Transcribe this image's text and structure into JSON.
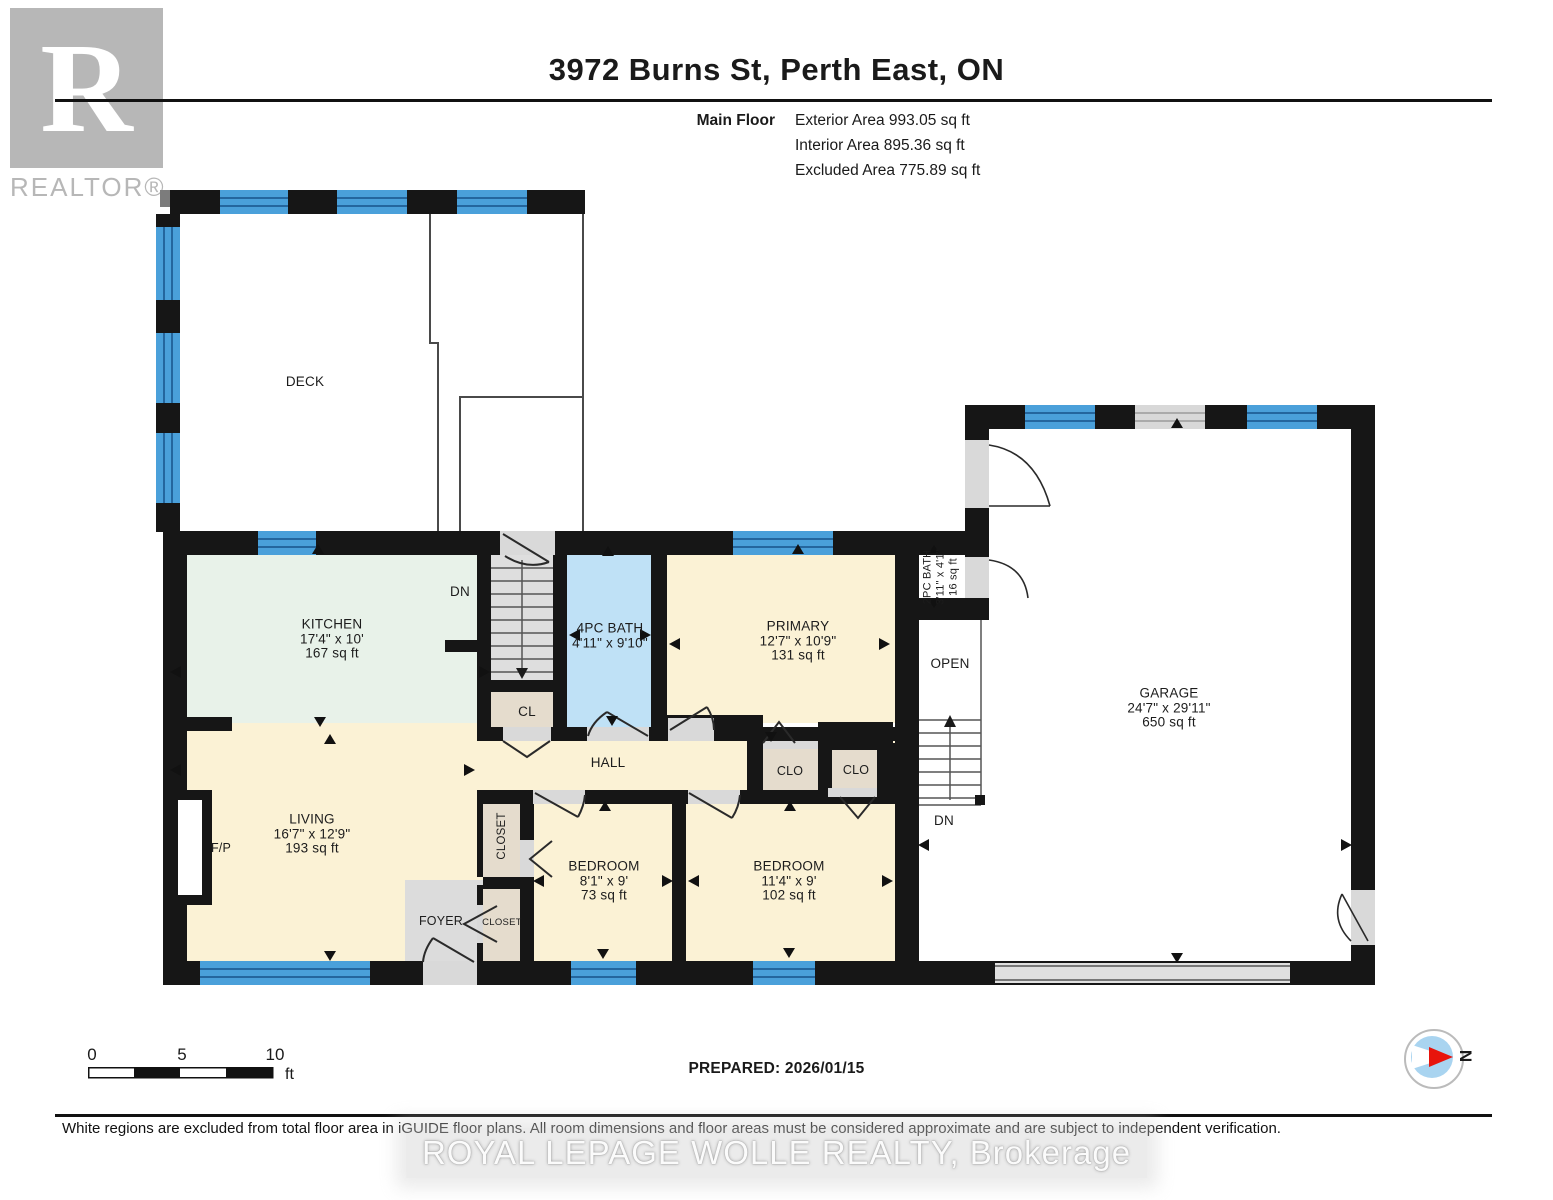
{
  "header": {
    "title": "3972 Burns St, Perth East, ON",
    "floor_label": "Main Floor",
    "exterior_area": "Exterior Area 993.05 sq ft",
    "interior_area": "Interior Area 895.36 sq ft",
    "excluded_area": "Excluded Area 775.89 sq ft"
  },
  "branding": {
    "logo_letter": "R",
    "logo_word": "REALTOR®",
    "watermark": "ROYAL LEPAGE WOLLE REALTY, Brokerage"
  },
  "rooms": {
    "kitchen": {
      "name": "KITCHEN",
      "dims": "17'4\" x 10'",
      "area": "167 sq ft"
    },
    "living": {
      "name": "LIVING",
      "dims": "16'7\" x 12'9\"",
      "area": "193 sq ft"
    },
    "bath4pc": {
      "name": "4PC BATH",
      "dims": "4'11\" x 9'10\""
    },
    "primary": {
      "name": "PRIMARY",
      "dims": "12'7\" x 10'9\"",
      "area": "131 sq ft"
    },
    "bath2pc": {
      "name": "2PC BATH",
      "dims": "3'11\" x 4'1\"",
      "area": "16 sq ft"
    },
    "bedroom1": {
      "name": "BEDROOM",
      "dims": "8'1\" x 9'",
      "area": "73 sq ft"
    },
    "bedroom2": {
      "name": "BEDROOM",
      "dims": "11'4\" x 9'",
      "area": "102 sq ft"
    },
    "garage": {
      "name": "GARAGE",
      "dims": "24'7\" x 29'11\"",
      "area": "650 sq ft"
    },
    "deck": {
      "name": "DECK"
    },
    "hall": {
      "name": "HALL"
    },
    "open": {
      "name": "OPEN"
    },
    "foyer": {
      "name": "FOYER"
    }
  },
  "labels": {
    "cl": "CL",
    "clo": "CLO",
    "closet": "CLOSET",
    "fireplace": "F/P",
    "down": "DN"
  },
  "footer": {
    "scale_0": "0",
    "scale_5": "5",
    "scale_10": "10",
    "scale_unit": "ft",
    "prepared": "PREPARED: 2026/01/15",
    "disclaimer": "White regions are excluded from total floor area in iGUIDE floor plans. All room dimensions and floor areas must be considered approximate and are subject to independent verification.",
    "compass_n": "N"
  },
  "colors": {
    "wall": "#161616",
    "window_blue": "#4aa0da",
    "window_stripe": "#24669e",
    "room_cream": "#fbf2d5",
    "kitchen_green": "#e8f2e9",
    "bath_blue": "#bfe1f6",
    "closet_tan": "#e5ddcf",
    "stair_gray": "#dedede",
    "door_gray": "#d9d9d9",
    "compass_red": "#e8140c",
    "compass_blue": "#a9d4f0"
  }
}
